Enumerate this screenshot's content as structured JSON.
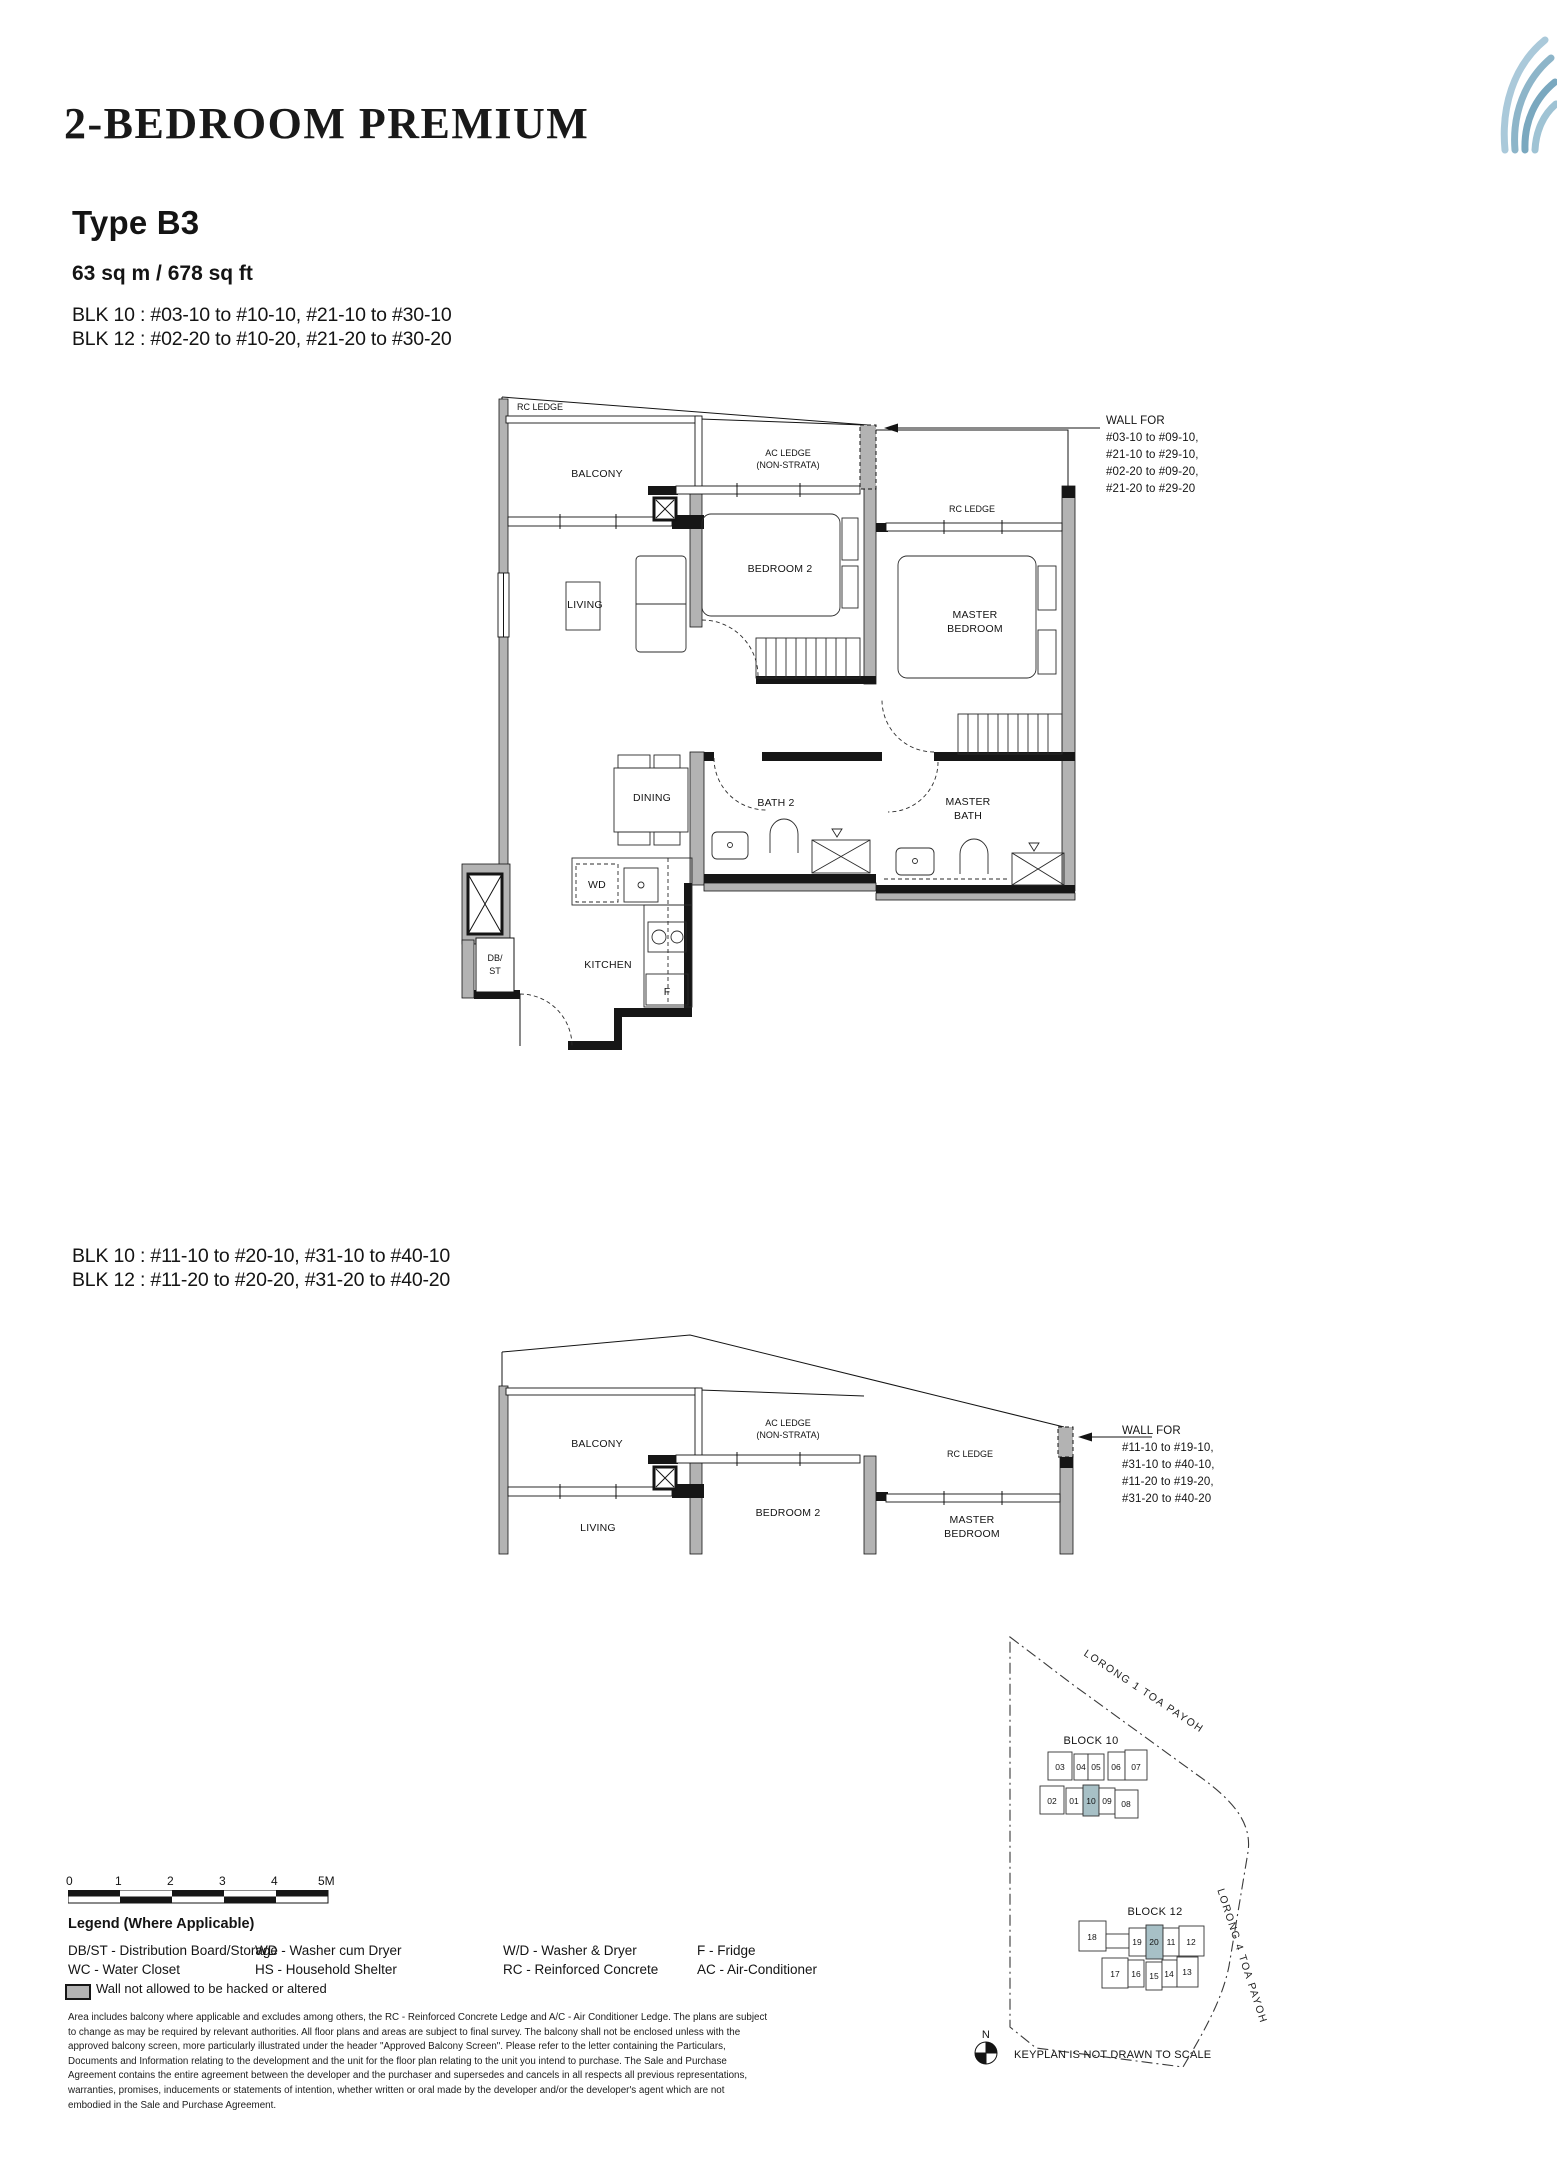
{
  "header": {
    "title": "2-BEDROOM PREMIUM",
    "unit_type": "Type B3",
    "area": "63 sq m / 678 sq ft",
    "blocks_low": [
      "BLK 10 : #03-10 to #10-10, #21-10 to #30-10",
      "BLK 12 : #02-20 to #10-20, #21-20 to #30-20"
    ],
    "blocks_high": [
      "BLK 10 : #11-10 to #20-10, #31-10 to #40-10",
      "BLK 12 : #11-20 to #20-20, #31-20 to #40-20"
    ]
  },
  "plan1": {
    "rc_ledge_top": "RC LEDGE",
    "balcony": "BALCONY",
    "ac_ledge_1": "AC LEDGE",
    "ac_ledge_2": "(NON-STRATA)",
    "rc_ledge_right": "RC LEDGE",
    "living": "LIVING",
    "bedroom2": "BEDROOM 2",
    "master_1": "MASTER",
    "master_2": "BEDROOM",
    "dining": "DINING",
    "bath2": "BATH 2",
    "master_bath_1": "MASTER",
    "master_bath_2": "BATH",
    "kitchen": "KITCHEN",
    "washer": "WD",
    "fridge": "F",
    "db_1": "DB/",
    "db_2": "ST",
    "wall_note_title": "WALL FOR",
    "wall_note_lines": [
      "#03-10 to #09-10,",
      "#21-10 to #29-10,",
      "#02-20 to #09-20,",
      "#21-20 to #29-20"
    ]
  },
  "plan2": {
    "balcony": "BALCONY",
    "living": "LIVING",
    "ac_ledge_1": "AC LEDGE",
    "ac_ledge_2": "(NON-STRATA)",
    "bedroom2": "BEDROOM 2",
    "rc_ledge": "RC LEDGE",
    "master_1": "MASTER",
    "master_2": "BEDROOM",
    "wall_note_title": "WALL FOR",
    "wall_note_lines": [
      "#11-10 to #19-10,",
      "#31-10 to #40-10,",
      "#11-20 to #19-20,",
      "#31-20 to #40-20"
    ]
  },
  "scalebar": {
    "ticks": [
      "0",
      "1",
      "2",
      "3",
      "4",
      "5M"
    ]
  },
  "legend": {
    "title": "Legend (Where Applicable)",
    "entries": [
      [
        "DB/ST - Distribution Board/Storage",
        "WC - Water Closet"
      ],
      [
        "WD - Washer cum Dryer",
        "HS - Household Shelter"
      ],
      [
        "W/D - Washer & Dryer",
        "RC - Reinforced Concrete"
      ],
      [
        "F - Fridge",
        "AC - Air-Conditioner"
      ]
    ],
    "wall_note": "Wall not allowed to be hacked or altered"
  },
  "disclaimer": "Area includes balcony where applicable and excludes among others, the RC - Reinforced Concrete Ledge and A/C - Air Conditioner Ledge. The plans are subject to change as may be required by relevant authorities. All floor plans and areas are subject to final survey. The balcony shall not be enclosed unless with the approved balcony screen, more particularly illustrated under the header \"Approved Balcony Screen\". Please refer to the letter containing the Particulars, Documents and Information relating to the development and the unit for the floor plan relating to the unit you intend to purchase. The Sale and Purchase Agreement contains the entire agreement between the developer and the purchaser and supersedes and cancels in all respects all previous representations, warranties, promises, inducements or statements of intention, whether written or oral made by the developer and/or the developer's agent which are not embodied in the Sale and Purchase Agreement.",
  "keyplan": {
    "block10_label": "BLOCK 10",
    "block12_label": "BLOCK 12",
    "block10_units_top": [
      "03",
      "04",
      "05",
      "06",
      "07"
    ],
    "block10_units_bottom": [
      "02",
      "01",
      "10",
      "09",
      "08"
    ],
    "block12_units_top": [
      "18",
      "19",
      "20",
      "11",
      "12"
    ],
    "block12_units_bottom": [
      "17",
      "16",
      "15",
      "14",
      "13"
    ],
    "highlighted_units": [
      "10",
      "20"
    ],
    "highlight_color": "#a7c0c6",
    "road_top": "LORONG 1 TOA PAYOH",
    "road_right": "LORONG 4 TOA PAYOH",
    "north_label": "N",
    "note": "KEYPLAN IS NOT DRAWN TO SCALE"
  }
}
